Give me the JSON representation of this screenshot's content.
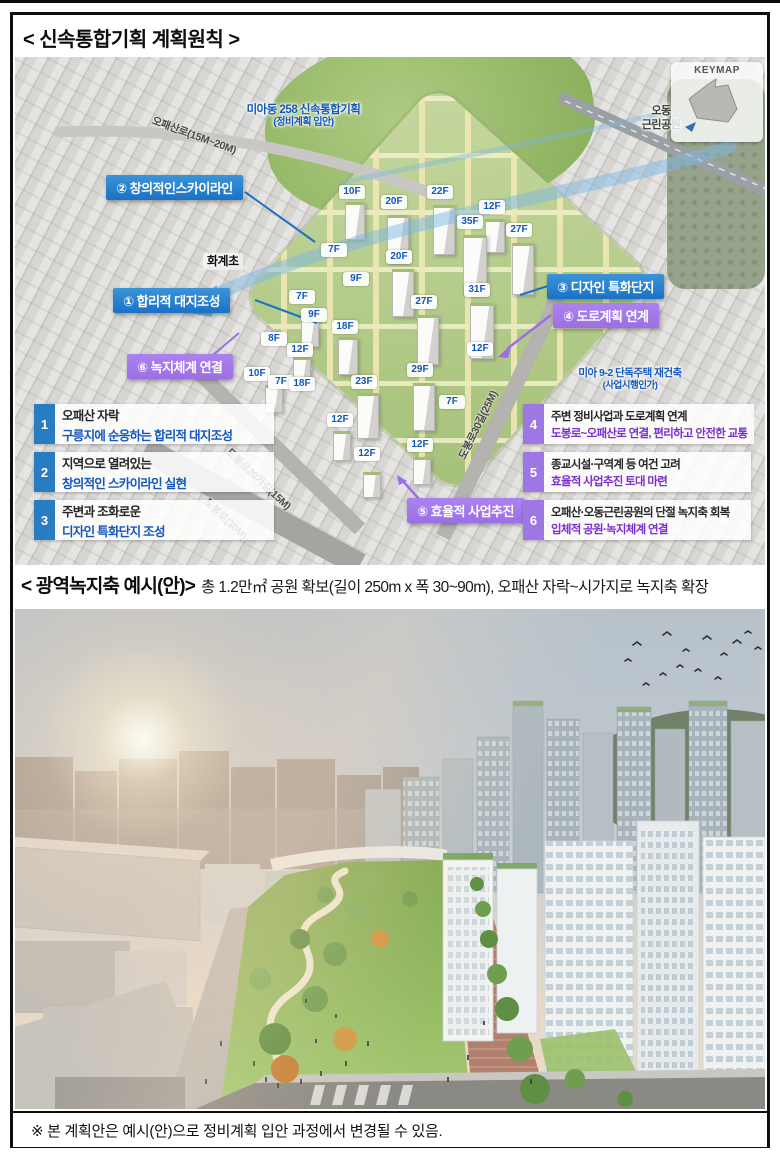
{
  "colors": {
    "accent_blue": "#1257be",
    "accent_purple": "#7b2ed2",
    "tab_blue": "#2a7cc0",
    "tab_purple": "#9e77e3",
    "callout_blue": "#1b72c6",
    "callout_purple": "#9c6fe4"
  },
  "header": {
    "title": "< 신속통합기획 계획원칙 >"
  },
  "aerial": {
    "keymap": {
      "label": "KEYMAP"
    },
    "labels": {
      "site_line1": "미아동 258 신속통합기획",
      "site_line2": "(정비계획 입안)",
      "park_line1": "오동",
      "park_line2": "근린공원",
      "school": "화계초",
      "adjacent_line1": "미아 9-2 단독주택 재건축",
      "adjacent_line2": "(사업시행인가)"
    },
    "roads": {
      "opaesan": "오패산로(15M~20M)",
      "dobong20": "도봉로20가길(15M)",
      "dobong30": "도봉로30길(25M)",
      "dobong": "도봉로(30M)"
    },
    "callouts": [
      {
        "text": "② 창의적인스카이라인"
      },
      {
        "text": "① 합리적 대지조성"
      },
      {
        "text": "③ 디자인 특화단지"
      },
      {
        "text": "④ 도로계획 연계"
      },
      {
        "text": "⑥ 녹지체계 연결"
      },
      {
        "text": "⑤ 효율적 사업추진"
      }
    ],
    "floor_labels": [
      "10F",
      "20F",
      "22F",
      "12F",
      "35F",
      "27F",
      "7F",
      "20F",
      "9F",
      "31F",
      "27F",
      "7F",
      "9F",
      "18F",
      "8F",
      "12F",
      "12F",
      "10F",
      "7F",
      "18F",
      "23F",
      "29F",
      "7F",
      "12F",
      "12F",
      "12F"
    ],
    "principles": [
      {
        "no": "1",
        "line1": "오패산 자락",
        "line2": "구릉지에 순응하는 합리적 대지조성"
      },
      {
        "no": "2",
        "line1": "지역으로 열려있는",
        "line2": "창의적인 스카이라인 실현"
      },
      {
        "no": "3",
        "line1": "주변과 조화로운",
        "line2": "디자인 특화단지 조성"
      },
      {
        "no": "4",
        "line1": "주변 정비사업과 도로계획 연계",
        "line2": "도봉로~오패산로 연결, 편리하고 안전한 교통"
      },
      {
        "no": "5",
        "line1": "종교시설·구역계 등 여건 고려",
        "line2": "효율적 사업추진 토대 마련"
      },
      {
        "no": "6",
        "line1": "오패산·오동근린공원의 단절 녹지축 회복",
        "line2": "입체적 공원·녹지체계 연결"
      }
    ]
  },
  "section2": {
    "title_bold": "< 광역녹지축 예시(안)>",
    "title_rest": "총 1.2만㎡ 공원 확보(길이 250m x 폭 30~90m), 오패산 자락~시가지로 녹지축 확장"
  },
  "footer": {
    "note": "※ 본 계획안은 예시(안)으로 정비계획 입안 과정에서 변경될 수 있음."
  }
}
